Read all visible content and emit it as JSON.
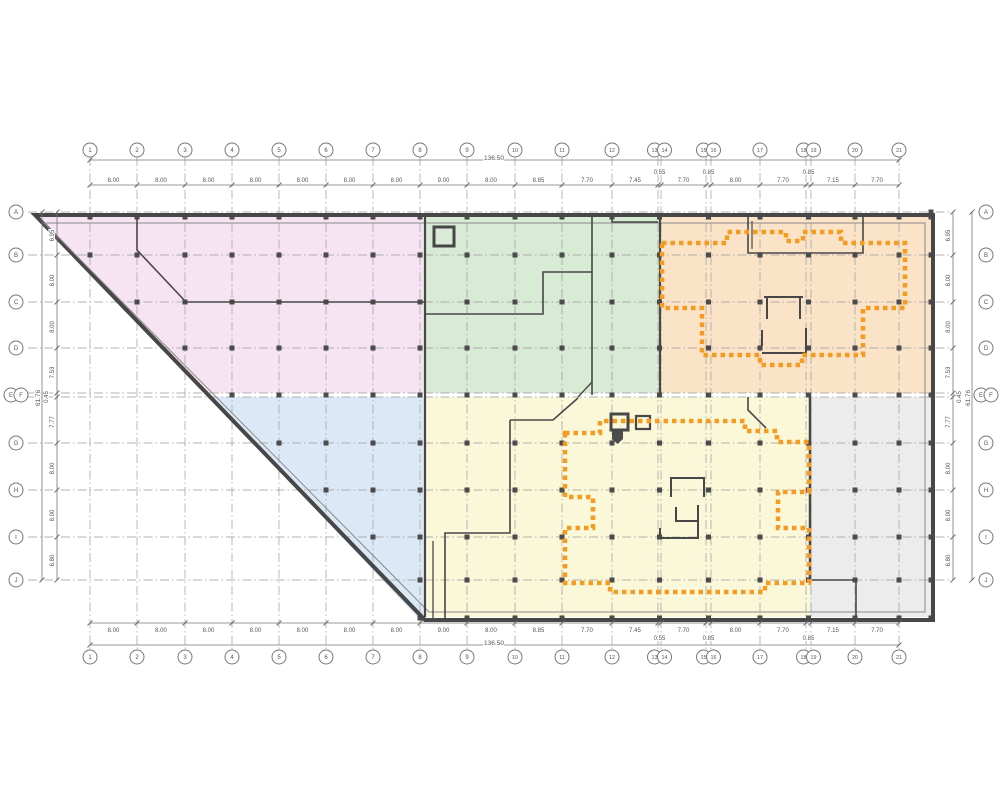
{
  "plan": {
    "canvas": {
      "w": 1000,
      "h": 800
    },
    "colors": {
      "zone_pink": "#f6e4f3",
      "zone_green": "#d8ebd4",
      "zone_peach": "#fae3c7",
      "zone_blue": "#dbe9f6",
      "zone_yellow": "#fbf8da",
      "zone_gray": "#ececec",
      "dash_orange": "#f59b20",
      "wall": "#474747",
      "grid": "#9b9b9b",
      "dim": "#555555",
      "bubble_stroke": "#777777"
    },
    "overall_width_label": "136.50",
    "overall_height_label": "61.76",
    "columns": [
      {
        "label": "1",
        "x": 90
      },
      {
        "label": "2",
        "x": 137
      },
      {
        "label": "3",
        "x": 185
      },
      {
        "label": "4",
        "x": 232
      },
      {
        "label": "5",
        "x": 279
      },
      {
        "label": "6",
        "x": 326
      },
      {
        "label": "7",
        "x": 373
      },
      {
        "label": "8",
        "x": 420
      },
      {
        "label": "9",
        "x": 467
      },
      {
        "label": "10",
        "x": 515
      },
      {
        "label": "11",
        "x": 562
      },
      {
        "label": "12",
        "x": 612
      },
      {
        "label": "13",
        "x": 658
      },
      {
        "label": "14",
        "x": 661
      },
      {
        "label": "15",
        "x": 706
      },
      {
        "label": "16",
        "x": 711
      },
      {
        "label": "17",
        "x": 760
      },
      {
        "label": "18",
        "x": 806
      },
      {
        "label": "19",
        "x": 811
      },
      {
        "label": "20",
        "x": 855
      },
      {
        "label": "21",
        "x": 899
      }
    ],
    "column_dims": [
      "8.00",
      "8.00",
      "8.00",
      "8.00",
      "8.00",
      "8.00",
      "8.00",
      "9.00",
      "8.00",
      "8.85",
      "7.70",
      "7.45",
      "0.55",
      "7.70",
      "0.85",
      "8.00",
      "7.70",
      "0.85",
      "7.15",
      "7.70"
    ],
    "rows": [
      {
        "label": "A",
        "y": 212
      },
      {
        "label": "B",
        "y": 255
      },
      {
        "label": "C",
        "y": 302
      },
      {
        "label": "D",
        "y": 348
      },
      {
        "label": "E",
        "y": 393
      },
      {
        "label": "F",
        "y": 397
      },
      {
        "label": "G",
        "y": 443
      },
      {
        "label": "H",
        "y": 490
      },
      {
        "label": "I",
        "y": 537
      },
      {
        "label": "J",
        "y": 580
      }
    ],
    "row_dims": [
      "6.95",
      "8.00",
      "8.00",
      "7.53",
      "0.45",
      "7.77",
      "8.00",
      "8.00",
      "6.80"
    ],
    "zones": [
      {
        "name": "zone-pink",
        "color_key": "zone_pink",
        "points": "37,217 425,217 425,393 206,393"
      },
      {
        "name": "zone-green",
        "color_key": "zone_green",
        "points": "425,217 660,217 660,393 425,393"
      },
      {
        "name": "zone-peach",
        "color_key": "zone_peach",
        "points": "660,217 931,217 931,393 660,393"
      },
      {
        "name": "zone-blue",
        "color_key": "zone_blue",
        "points": "210,397 425,397 425,617 417,617"
      },
      {
        "name": "zone-yellow",
        "color_key": "zone_yellow",
        "points": "425,397 810,397 810,617 425,617"
      },
      {
        "name": "zone-gray",
        "color_key": "zone_gray",
        "points": "810,397 931,397 931,617 810,617"
      }
    ],
    "outline": "M35,215 H933 V620 H425 Z",
    "outline_inner": "M44,223 H925 V612 H429 Z",
    "walls": [
      {
        "d": "M137,217 V250 L186,302 H425",
        "w": 1.6
      },
      {
        "d": "M425,314 H543 V272 H592",
        "w": 1.6
      },
      {
        "d": "M592,217 V395",
        "w": 1.6
      },
      {
        "d": "M578,397 L592,382",
        "w": 1.3
      },
      {
        "d": "M612,217 V222 H658",
        "w": 1.6
      },
      {
        "d": "M434,227 h20 v19 h-20 Z",
        "w": 3
      },
      {
        "d": "M748,217 V253 H863 V217",
        "w": 1.6
      },
      {
        "d": "M752,221 V249",
        "w": 1.2
      },
      {
        "d": "M764,297 H803 M767,297 V319 M800,297 V319",
        "w": 2
      },
      {
        "d": "M762,330 V346 M806,328 V355 M762,353 H806",
        "w": 2
      },
      {
        "d": "M510,420 H553 L578,398",
        "w": 1.6
      },
      {
        "d": "M510,420 V533 H445 V618",
        "w": 1.6
      },
      {
        "d": "M433,541 V618",
        "w": 1.3
      },
      {
        "d": "M748,397 V410 L766,428",
        "w": 1.6
      },
      {
        "d": "M611,414 h17 v16 h-17 Z",
        "w": 3
      },
      {
        "d": "M636,416 h14 v13 h-14 Z",
        "w": 2.2
      },
      {
        "d": "M671,497 V478 H704 V497",
        "w": 2
      },
      {
        "d": "M676,507 V521 H698 M698,505 V538 H660 V528",
        "w": 2
      },
      {
        "d": "M810,397 V583",
        "w": 2.5
      },
      {
        "d": "M812,580 H856 V618",
        "w": 1.6
      },
      {
        "d": "M425,217 V617",
        "w": 2.2
      },
      {
        "d": "M660,217 V393",
        "w": 2.2
      }
    ],
    "filled_shapes": [
      {
        "d": "M612,431 h11 v8 l-5.5,5 l-5.5,-5 Z"
      }
    ],
    "dashed_outlines": [
      {
        "name": "tower-footprint-upper",
        "d": "M662,243 H727 V232 H786 V241 H803 V232 H841 V243 H905 V308 H863 V355 H802 V365 H760 V355 H702 V308 H662 Z"
      },
      {
        "name": "tower-footprint-lower",
        "d": "M565,433 H600 V421 H745 V431 H777 V442 H809 V492 H778 V528 H809 V583 H765 V592 H610 V583 H565 V528 H593 V497 H565 Z"
      }
    ],
    "layout": {
      "grid_v_y1": 157,
      "grid_v_y2": 650,
      "grid_h_x1": 28,
      "grid_h_x2": 950,
      "top_bubble_y": 150,
      "bottom_bubble_y": 657,
      "left_bubble_x": 16,
      "right_bubble_x": 986,
      "top_dim_y": 185,
      "top_overall_y": 160,
      "bottom_dim_y": 623,
      "bottom_overall_y": 645,
      "left_dim_x": 57,
      "left_overall_x": 42,
      "right_dim_x": 953,
      "right_overall_x": 972,
      "diag_x1": 35,
      "diag_y1": 215,
      "diag_x2": 425,
      "diag_y2": 620,
      "bubble_r": 7
    }
  }
}
